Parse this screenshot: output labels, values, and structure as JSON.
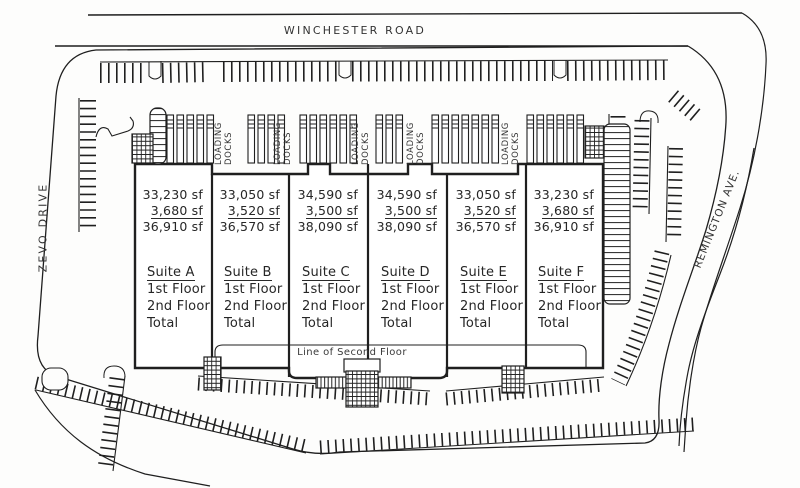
{
  "roads": {
    "top_label": "WINCHESTER ROAD",
    "left_label": "ZEVO DRIVE",
    "right_label": "REMINGTON AVE."
  },
  "building": {
    "loading_docks_label": "LOADING DOCKS",
    "second_floor_note": "Line of Second Floor",
    "floor_rows": [
      "1st Floor",
      "2nd Floor",
      "Total"
    ],
    "suites": [
      {
        "name": "Suite A",
        "first_floor_sf": "33,230 sf",
        "second_floor_sf": "3,680 sf",
        "total_sf": "36,910 sf"
      },
      {
        "name": "Suite B",
        "first_floor_sf": "33,050 sf",
        "second_floor_sf": "3,520 sf",
        "total_sf": "36,570 sf"
      },
      {
        "name": "Suite C",
        "first_floor_sf": "34,590 sf",
        "second_floor_sf": "3,500 sf",
        "total_sf": "38,090 sf"
      },
      {
        "name": "Suite D",
        "first_floor_sf": "34,590 sf",
        "second_floor_sf": "3,500 sf",
        "total_sf": "38,090 sf"
      },
      {
        "name": "Suite E",
        "first_floor_sf": "33,050 sf",
        "second_floor_sf": "3,520 sf",
        "total_sf": "36,570 sf"
      },
      {
        "name": "Suite F",
        "first_floor_sf": "33,230 sf",
        "second_floor_sf": "3,680 sf",
        "total_sf": "36,910 sf"
      }
    ]
  }
}
